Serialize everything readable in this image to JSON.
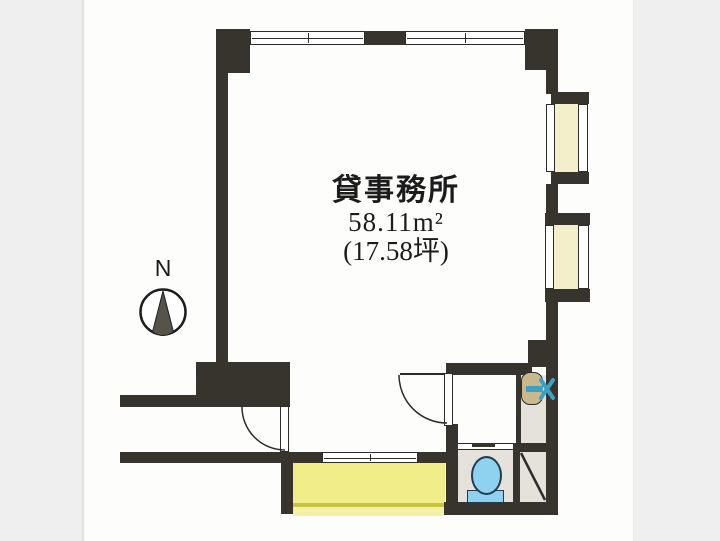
{
  "floor_plan": {
    "room_label": "貸事務所",
    "area_sqm": "58.11m²",
    "area_tsubo": "(17.58坪)",
    "compass": {
      "label": "N"
    }
  },
  "icons": {
    "compass": "compass-north-needle",
    "toilet": "toilet-bowl",
    "sink": "sink-basin-with-faucet",
    "pipe_space": "diagonal-slash",
    "doors": "quarter-circle-door-swing",
    "windows": "double-line-window"
  },
  "colors": {
    "wall": "#36342c",
    "line": "#2c2c2c",
    "page_gray": "#efeff0",
    "paper_white": "#fdfdfb",
    "balcony_yellow": "#f1ee8a",
    "balcony_edge": "#c8c340",
    "balcony_outer": "#f4f1a6",
    "bay_cream": "#f3efca",
    "utility_floor": "#e4e2da",
    "toilet_blue": "#8ed2f0",
    "toilet_outline": "#223c4e",
    "sink_tan": "#c8b88c",
    "faucet_blue": "#3da0c4"
  }
}
